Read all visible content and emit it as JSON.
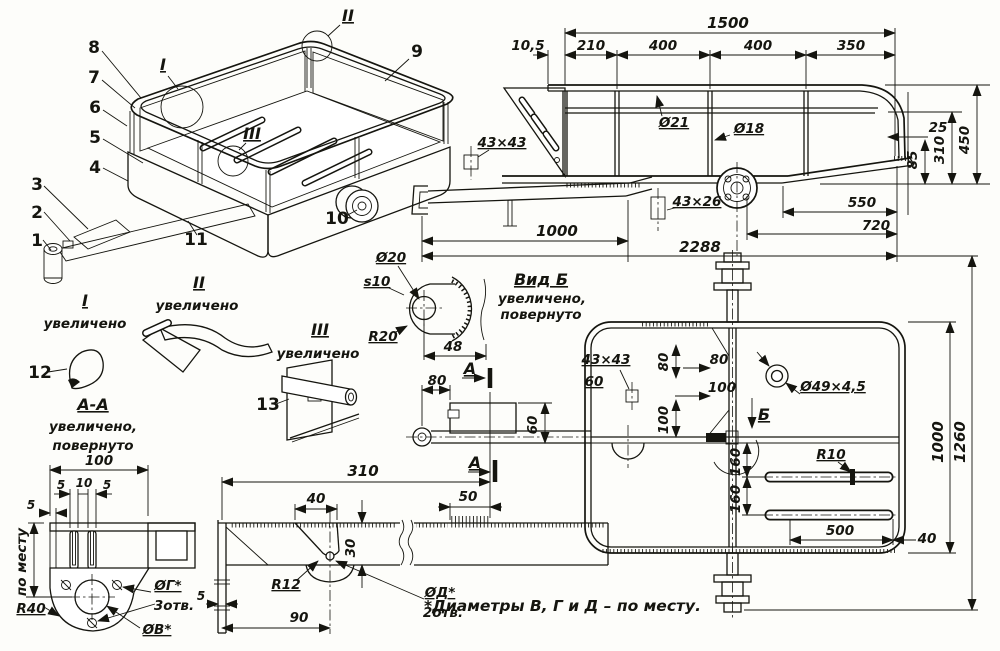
{
  "callouts": {
    "c1": "1",
    "c2": "2",
    "c3": "3",
    "c4": "4",
    "c5": "5",
    "c6": "6",
    "c7": "7",
    "c8": "8",
    "c9": "9",
    "c10": "10",
    "c11": "11",
    "c12": "12",
    "c13": "13"
  },
  "pers": {
    "m1": "I",
    "m2": "II",
    "m3": "III"
  },
  "details": {
    "i_t": "I",
    "i_n": "увеличено",
    "ii_t": "II",
    "ii_n": "увеличено",
    "iii_t": "III",
    "iii_n": "увеличено",
    "aa_t": "А-А",
    "aa_n1": "увеличено,",
    "aa_n2": "повернуто",
    "vb_t": "Вид Б",
    "vb_n1": "увеличено,",
    "vb_n2": "повернуто"
  },
  "side": {
    "w1500": "1500",
    "w105": "10,5",
    "w210": "210",
    "w400a": "400",
    "w400b": "400",
    "w350": "350",
    "d21": "Ø21",
    "d18": "Ø18",
    "t4343": "43×43",
    "t4326": "43×26",
    "w1000": "1000",
    "w2288": "2288",
    "w550": "550",
    "w720": "720",
    "h25": "25",
    "h85": "85",
    "h310": "310",
    "h450": "450"
  },
  "plate": {
    "d20": "Ø20",
    "s10": "s10",
    "r20": "R20",
    "w48": "48"
  },
  "plan": {
    "t4343": "43×43",
    "l60": "60",
    "l60v": "60",
    "v80": "80",
    "h80": "80",
    "h100": "100",
    "v100": "100",
    "d49": "Ø49×4,5",
    "b": "Б",
    "a": "А",
    "r10": "R10",
    "l160a": "160",
    "l160b": "160",
    "w500": "500",
    "w40": "40",
    "v1000": "1000",
    "v1260": "1260",
    "w80": "80",
    "w50": "50"
  },
  "aa": {
    "w100": "100",
    "g5a": "5",
    "g10": "10",
    "g5b": "5",
    "g5c": "5",
    "fit": "по месту",
    "r40": "R40",
    "dg": "ØГ*",
    "dgn": "3отв.",
    "dv": "ØВ*"
  },
  "bar": {
    "w310": "310",
    "w40": "40",
    "h30": "30",
    "r12": "R12",
    "dd": "ØД*",
    "ddn": "2отв.",
    "w90": "90",
    "g5": "5",
    "a": "А"
  },
  "footnote": "*Диаметры В, Г и Д – по месту."
}
